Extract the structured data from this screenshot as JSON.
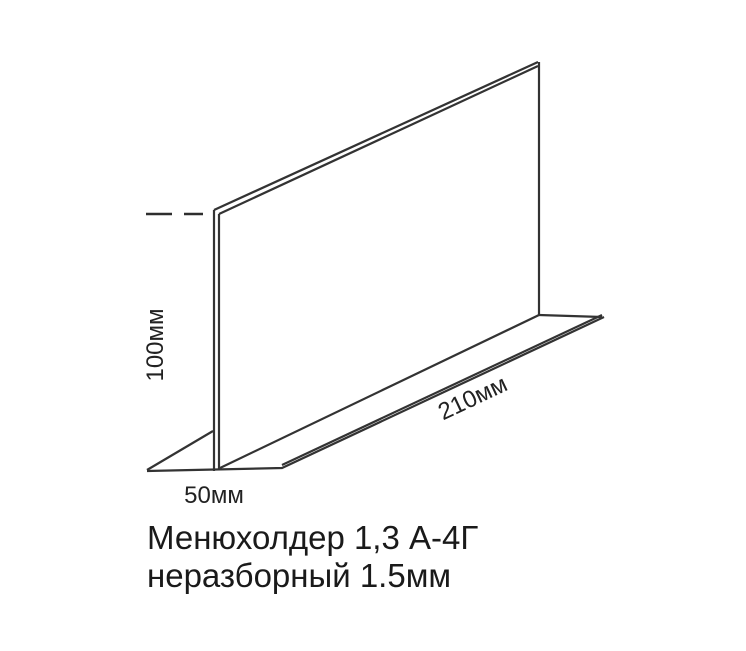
{
  "diagram": {
    "labels": {
      "height": "100мм",
      "length": "210мм",
      "depth": "50мм"
    },
    "title": {
      "line1": "Менюхолдер 1,3 А-4Г",
      "line2": "неразборный 1.5мм"
    },
    "colors": {
      "line": "#333333",
      "text": "#1a1a1a",
      "background": "#ffffff"
    }
  }
}
